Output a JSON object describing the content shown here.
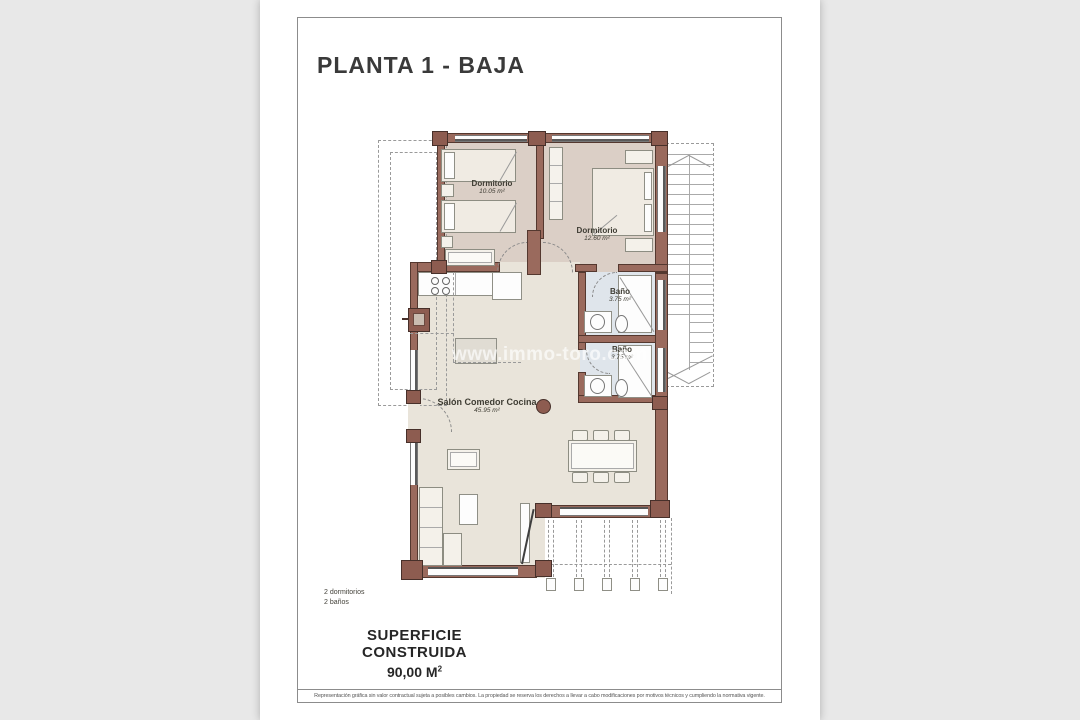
{
  "sheet": {
    "title": "PLANTA 1 - BAJA",
    "watermark": "www.immo-toro.com",
    "summary_line1": "2 dormitorios",
    "summary_line2": "2 baños",
    "surface_label": "SUPERFICIE CONSTRUIDA",
    "surface_value": "90,00 M",
    "surface_value_sup": "2",
    "disclaimer": "Representación gráfica sin valor contractual sujeta a posibles cambios. La propiedad se reserva los derechos a llevar a cabo modificaciones por motivos técnicos y cumpliendo la normativa vigente."
  },
  "rooms": [
    {
      "name": "Dormitorio",
      "area": "10.05 m²"
    },
    {
      "name": "Dormitorio",
      "area": "12.60 m²"
    },
    {
      "name": "Baño",
      "area": "3.75 m²"
    },
    {
      "name": "Baño",
      "area": "3.75 m²"
    },
    {
      "name": "Salón Comedor Cocina",
      "area": "45.95 m²"
    }
  ],
  "colors": {
    "wall": "#9a6a5d",
    "pillar": "#8d5c50",
    "bedroom_floor": "#dbcfc6",
    "living_floor": "#e9e4da",
    "bath_floor": "#dfe5eb",
    "paper": "#ffffff",
    "background": "#e8e8e8"
  }
}
